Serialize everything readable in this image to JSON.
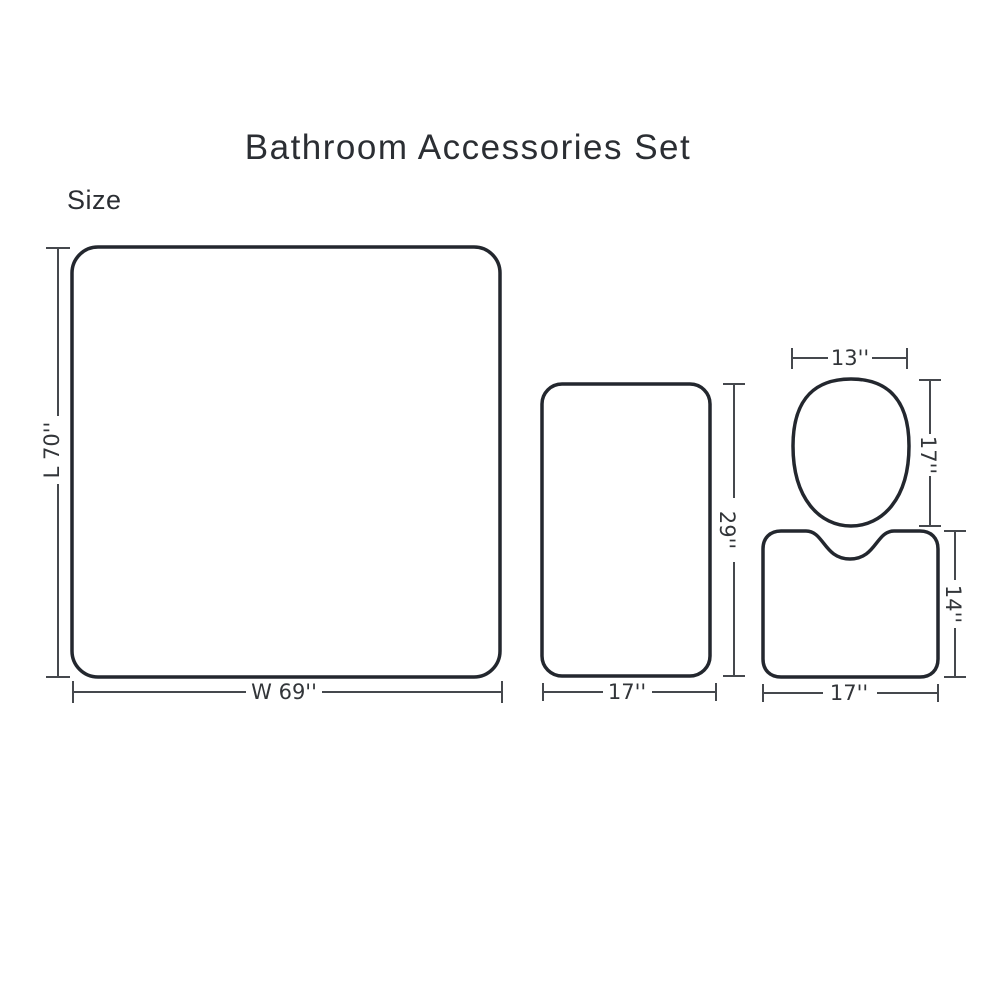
{
  "title": "Bathroom Accessories Set",
  "size_heading": "Size",
  "colors": {
    "shape_stroke": "#23272e",
    "dimension_stroke": "#45484d",
    "label_text": "#323539",
    "title_text": "#2b2e33",
    "background": "#ffffff"
  },
  "items": {
    "shower_curtain": {
      "length_label": "L 70''",
      "width_label": "W 69''"
    },
    "bath_mat": {
      "height_label": "29''",
      "width_label": "17''"
    },
    "toilet_lid_cover": {
      "width_label": "13''",
      "height_label": "17''"
    },
    "contour_mat": {
      "height_label": "14''",
      "width_label": "17''"
    }
  }
}
